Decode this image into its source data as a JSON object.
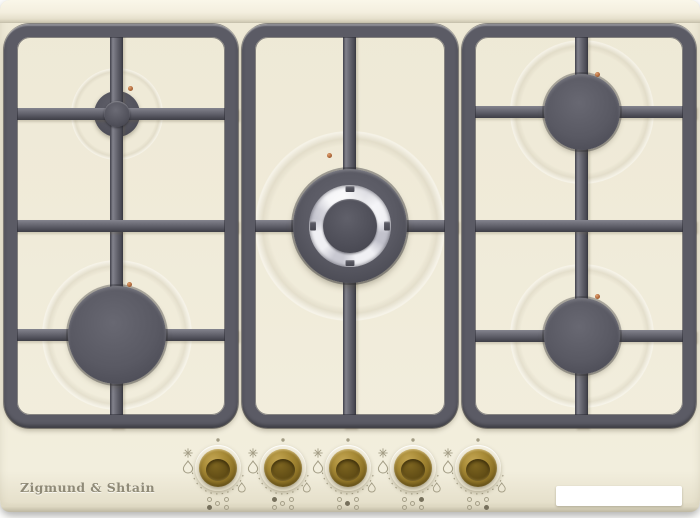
{
  "product": {
    "brand_logo": "Zigmund & Shtain"
  },
  "hob": {
    "burner_count": 5,
    "burners": [
      {
        "id": "rear-left",
        "type": "auxiliary-small"
      },
      {
        "id": "front-left",
        "type": "rapid-large"
      },
      {
        "id": "center",
        "type": "wok-triple-crown-chrome-ring"
      },
      {
        "id": "rear-right",
        "type": "semi-rapid"
      },
      {
        "id": "front-right",
        "type": "semi-rapid"
      }
    ],
    "knobs": [
      {
        "id": "knob-1",
        "controls": "front-left"
      },
      {
        "id": "knob-2",
        "controls": "rear-left"
      },
      {
        "id": "knob-3",
        "controls": "center"
      },
      {
        "id": "knob-4",
        "controls": "rear-right"
      },
      {
        "id": "knob-5",
        "controls": "front-right"
      }
    ],
    "knob_markings": {
      "spark": "spark-icon",
      "flame_max": "flame-max-icon",
      "flame_min": "flame-min-icon",
      "off_dot": "off-position-dot"
    }
  },
  "sticker": {
    "text": ""
  },
  "colors": {
    "surface_cream": "#efead7",
    "surface_bevel": "#f7f3e3",
    "grate_graphite": "#5b5b65",
    "grate_shadow": "#3b3b43",
    "burner_cap": "#54545e",
    "chrome_ring": "#e9e9ee",
    "knob_brass": "#9c8030",
    "knob_brass_dark": "#6e581c",
    "ignition_copper": "#b06a3c",
    "marking_gray": "#a39d85",
    "sticker_white": "#ffffff"
  }
}
